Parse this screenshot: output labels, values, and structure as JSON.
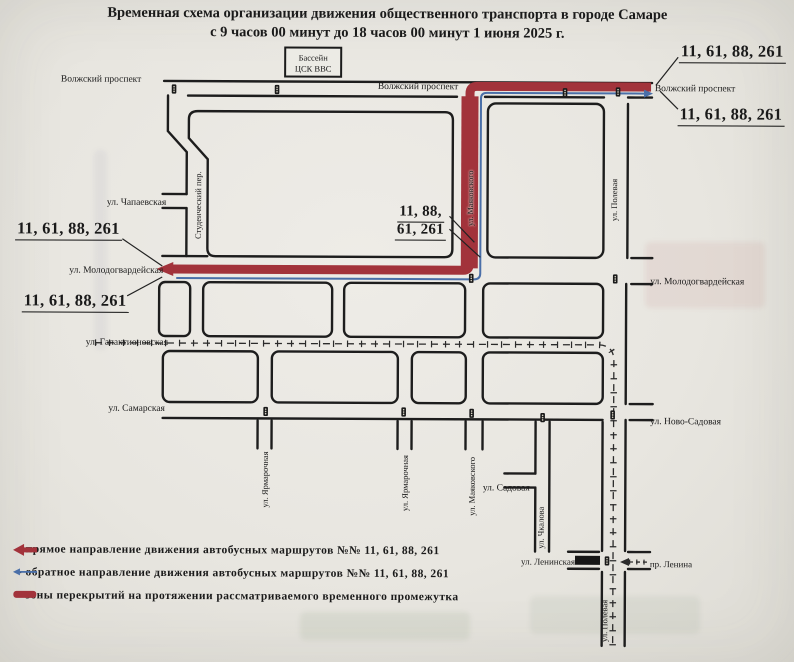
{
  "title": {
    "line1": "Временная схема организации движения общественного транспорта в городе Самаре",
    "line2": "с 9 часов 00 минут до 18 часов 00 минут 1 июня 2025 г."
  },
  "pool_box": {
    "line1": "Бассейн",
    "line2": "ЦСК ВВС"
  },
  "streets": {
    "volzhsky_left": "Волжский проспект",
    "volzhsky_center": "Волжский проспект",
    "volzhsky_right": "Волжский проспект",
    "chapaevskaya": "ул. Чапаевская",
    "studencheskiy": "Студенческий пер.",
    "mayakovskogo_north": "ул. Маяковского",
    "molodogvardeyskaya_left": "ул. Молодогвардейская",
    "molodogvardeyskaya_right": "ул. Молодогвардейская",
    "galaktionovskaya": "ул. Галактионовская",
    "samarskaya": "ул. Самарская",
    "yarmarochnaya_1": "ул. Ярмарочная",
    "yarmarochnaya_2": "ул. Ярмарочная",
    "mayakovskogo_south": "ул. Маяковского",
    "sadovaya": "ул. Садовая",
    "chkalova": "ул. Чкалова",
    "polevaya_north": "ул. Полевая",
    "polevaya_south": "ул. Полевая",
    "novo_sadovaya": "ул. Ново-Садовая",
    "leninskaya": "ул. Ленинская",
    "lenina": "пр. Ленина"
  },
  "route_labels": {
    "top_right_1": "11, 61, 88, 261",
    "top_right_2": "11, 61, 88, 261",
    "left_1": "11, 61, 88, 261",
    "left_2": "11, 61, 88, 261",
    "center_line1": "11, 88,",
    "center_line2": "61, 261"
  },
  "legend": {
    "direct": {
      "text": "- прямое направление движения автобусных маршрутов №№ 11, 61, 88, 261"
    },
    "reverse": {
      "text": "- обратное направление движения автобусных маршрутов №№ 11, 61, 88, 261"
    },
    "closure": {
      "text": "- зоны перекрытий на протяжении рассматриваемого временного промежутка"
    }
  },
  "colors": {
    "closure_red": "#a2333b",
    "reverse_blue": "#4a6fa8",
    "road_black": "#1d1d1d"
  }
}
